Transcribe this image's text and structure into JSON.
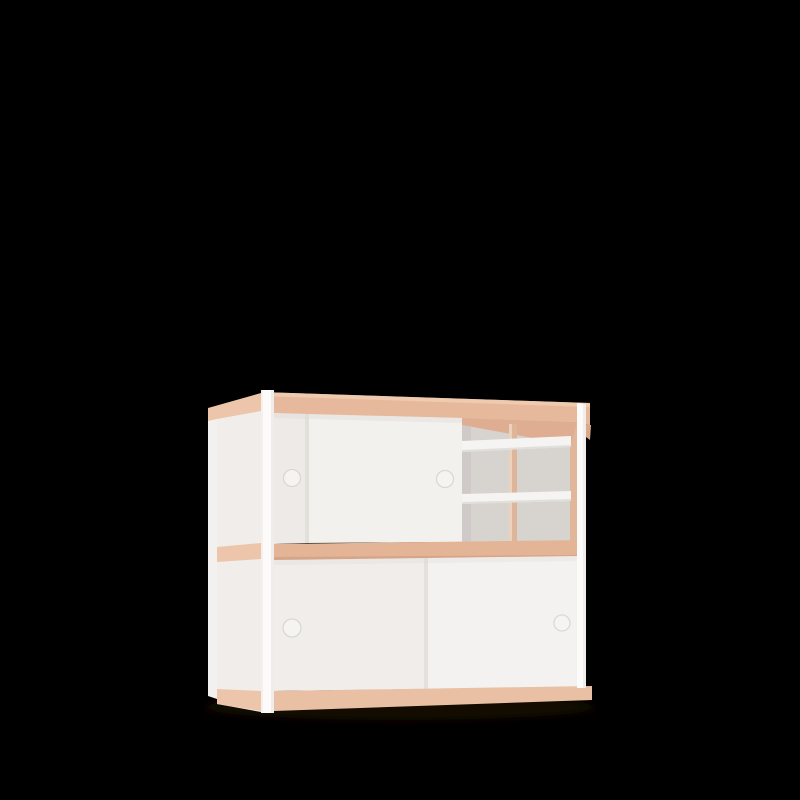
{
  "meta": {
    "description": "3D product render of a two-tier sideboard cabinet with white sliding doors, exposed plywood edge bands, an open shelf compartment, round finger-hole handles, shown in three-quarter view on a black background",
    "canvas": {
      "width": 800,
      "height": 800
    }
  },
  "scene": {
    "background": "black",
    "object": "plywood-and-white sideboard cabinet",
    "parts": {
      "top_panel": "plywood edge band",
      "middle_panel": "plywood edge band",
      "bottom_panel": "plywood edge band",
      "top_section": "two sliding doors (one open) + open shelf compartment with two shelves and center divider",
      "bottom_section": "two sliding doors",
      "frame": "white corner posts",
      "handles": "four round finger holes"
    }
  },
  "colors": {
    "background": "#000000",
    "ground_shadow": "#170d06",
    "wood_top": "#e7b99c",
    "wood_top_highlight": "#f2d0b5",
    "wood_side_band": "#edc5aa",
    "wood_middle": "#e4b496",
    "wood_middle_dark": "#d2a185",
    "wood_bottom": "#e9c0a4",
    "wood_under": "#dfae92",
    "wood_under_side": "#e2b69a",
    "wood_divider": "#dcb59b",
    "wood_divider_highlight": "#f0d9c6",
    "wood_right_sliver": "#d8a98d",
    "post_white": "#fcfbfa",
    "post_shade": "#e9e5e1",
    "back_post": "#f3f1ef",
    "side_panel": "#f0edea",
    "door_back_top": "#eeeae7",
    "door_front_top": "#f3f1ee",
    "door_bottom_left": "#f0edeb",
    "door_bottom_right": "#f4f2f0",
    "edge_shadow": "#d5d0cc",
    "band_cast_shadow": "#e0dcd8",
    "interior_back": "#d7d3cf",
    "interior_shadow": "#c9c5c1",
    "shelf_front": "#f6f4f2",
    "shelf_edge_shadow": "#d9d5d1",
    "handle_fill": "#f6f4f2",
    "handle_ring": "#dcd7d3"
  }
}
